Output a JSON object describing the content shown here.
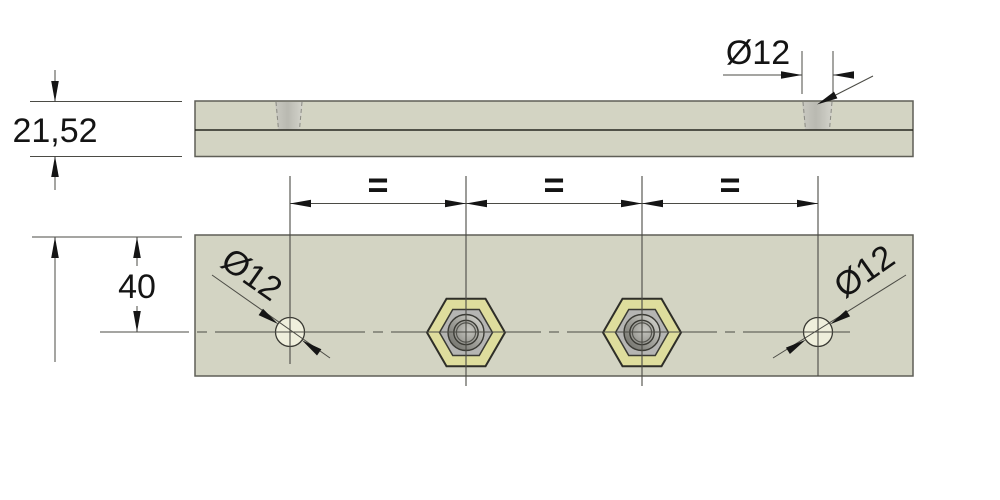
{
  "dimensions": {
    "thickness": "21,52",
    "hole_diameter_side": "Ø12",
    "edge_to_center": "40",
    "hole_diameter_left": "Ø12",
    "hole_diameter_right": "Ø12",
    "equal_spacing": [
      "=",
      "=",
      "="
    ]
  },
  "colors": {
    "background": "#ffffff",
    "plate": "#d3d4c3",
    "hole": "#efefdc",
    "nut_face": "#dedd9d",
    "nut_inner": "#b5b5b3",
    "outline": "#2e2e28",
    "dimension_line": "#4b4b45",
    "text": "#141414"
  }
}
